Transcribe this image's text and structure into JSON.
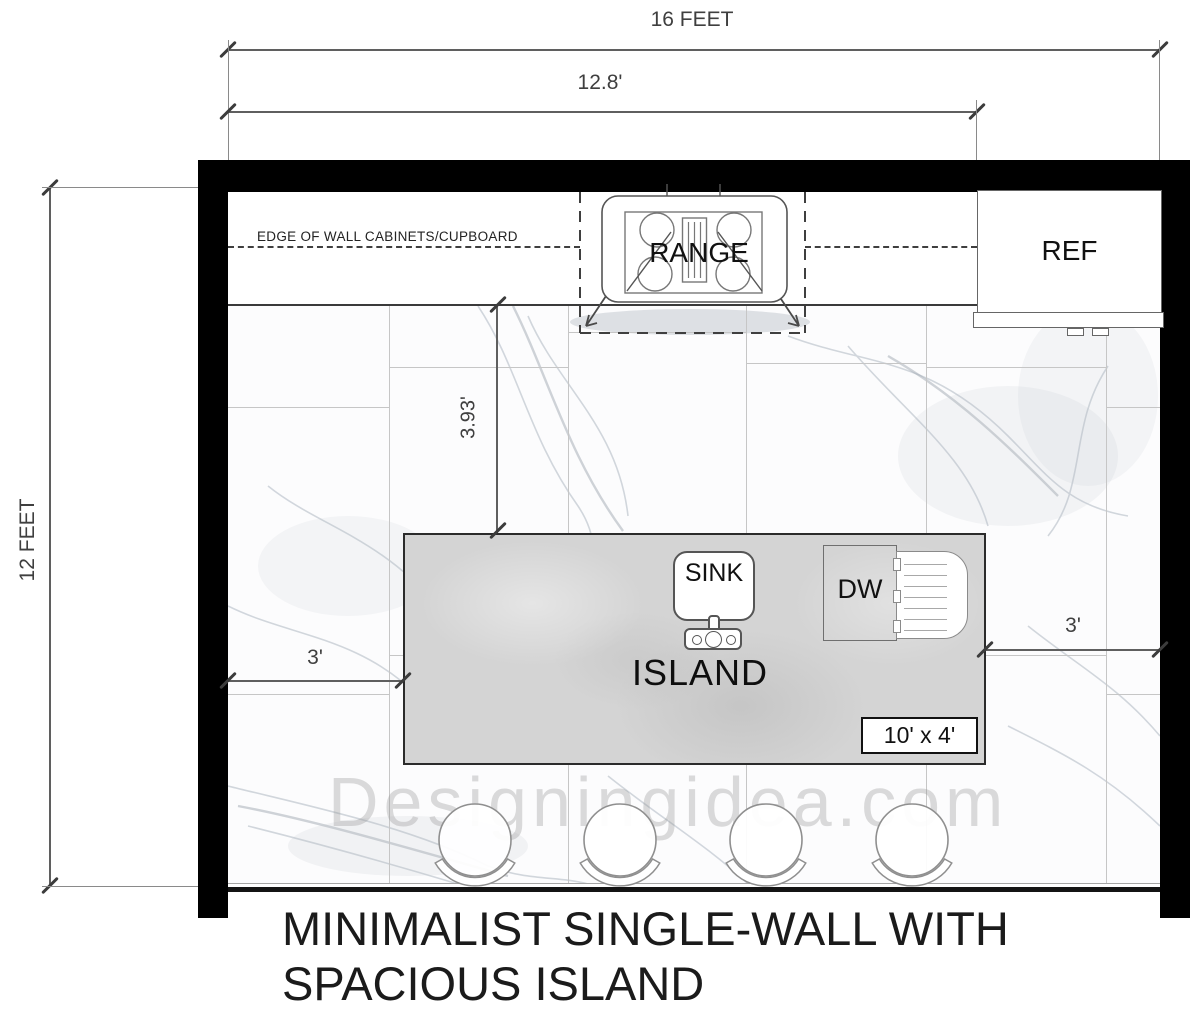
{
  "dims": {
    "total_width": "16 FEET",
    "counter_run": "12.8'",
    "total_depth": "12 FEET",
    "counter_to_island": "3.93'",
    "left_clearance": "3'",
    "right_clearance": "3'"
  },
  "notes": {
    "cabinet_edge": "EDGE OF WALL CABINETS/CUPBOARD"
  },
  "appliances": {
    "range": "RANGE",
    "fridge": "REF"
  },
  "island": {
    "label": "ISLAND",
    "sink": "SINK",
    "dishwasher": "DW",
    "size": "10' x 4'"
  },
  "stools": {
    "count": 4
  },
  "watermark": {
    "text": "Designingidea.com"
  },
  "title": {
    "line1": "MINIMALIST SINGLE-WALL WITH",
    "line2": "SPACIOUS ISLAND"
  },
  "colors": {
    "wall": "#000000",
    "dim": "#5f5f5f",
    "dash": "#3f3f3f",
    "tile_line": "#c6c6c6",
    "island_fill": "#d4d4d4",
    "ink": "#1b1b1b"
  }
}
